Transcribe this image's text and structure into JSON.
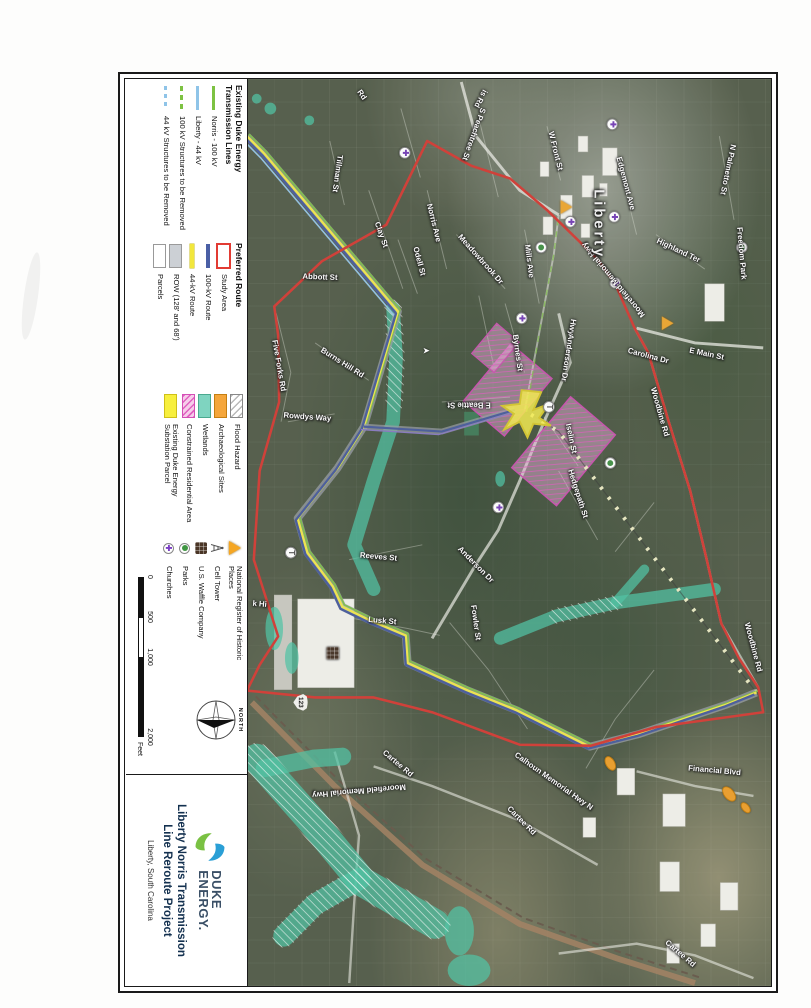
{
  "title_block": {
    "brand_line1": "DUKE",
    "brand_line2": "ENERGY.",
    "project_title_line1": "Liberty Norris Transmission",
    "project_title_line2": "Line Reroute Project",
    "location": "Liberty, South Carolina"
  },
  "legend": {
    "sections": [
      {
        "header": "Existing Duke Energy\nTransmission Lines",
        "items": [
          {
            "swatch": "line-green",
            "label": "Norris - 100 kV"
          },
          {
            "swatch": "line-lightblue",
            "label": "Liberty - 44 kV"
          },
          {
            "swatch": "dash-green",
            "label": "100 kV Structures to be Removed"
          },
          {
            "swatch": "dash-blue",
            "label": "44 kV Structures to be Removed"
          }
        ]
      },
      {
        "header": "Preferred Route",
        "items": [
          {
            "swatch": "rect-red-outline",
            "label": "Study Area"
          },
          {
            "swatch": "line-navy",
            "label": "100-kV Route"
          },
          {
            "swatch": "line-yellow",
            "label": "44-kV Route"
          },
          {
            "swatch": "rect-gray",
            "label": "ROW (128' and 68')"
          },
          {
            "swatch": "rect-white",
            "label": "Parcels"
          }
        ]
      },
      {
        "header": "",
        "items": [
          {
            "swatch": "rect-hatch-white",
            "label": "Flood Hazard"
          },
          {
            "swatch": "rect-orange",
            "label": "Archaeological Sites"
          },
          {
            "swatch": "rect-teal",
            "label": "Wetlands"
          },
          {
            "swatch": "rect-hatch-pink",
            "label": "Constrained Residential Area"
          },
          {
            "swatch": "rect-yellow",
            "label": "Existing Duke Energy Substation Parcel"
          }
        ]
      },
      {
        "header": "",
        "items": [
          {
            "swatch": "icon-triangle",
            "label": "National Register of Historic Places"
          },
          {
            "swatch": "icon-tower",
            "label": "Cell Tower"
          },
          {
            "swatch": "icon-waffle",
            "label": "U.S. Waffle Company"
          },
          {
            "swatch": "icon-park",
            "label": "Parks"
          },
          {
            "swatch": "icon-church",
            "label": "Churches"
          }
        ]
      }
    ],
    "scale": {
      "ticks": [
        "0",
        "500",
        "1,000",
        "2,000"
      ],
      "unit": "Feet"
    },
    "north_label": "NORTH"
  },
  "map": {
    "city_label": "Liberty",
    "highway_shield": "123",
    "streets": [
      {
        "name": "Rd",
        "x": 16,
        "y": 420,
        "a": -35
      },
      {
        "name": "is Rd",
        "x": 20,
        "y": 298,
        "a": 28
      },
      {
        "name": "Tillman St",
        "x": 96,
        "y": 445,
        "a": 8
      },
      {
        "name": "Clay St",
        "x": 158,
        "y": 400,
        "a": -20
      },
      {
        "name": "S Peachtree St",
        "x": 56,
        "y": 305,
        "a": 20
      },
      {
        "name": "Norris Ave",
        "x": 146,
        "y": 346,
        "a": -14
      },
      {
        "name": "Odell St",
        "x": 185,
        "y": 361,
        "a": -15
      },
      {
        "name": "Meadowbrook Dr",
        "x": 183,
        "y": 298,
        "a": -42
      },
      {
        "name": "Mills Ave",
        "x": 185,
        "y": 248,
        "a": -7
      },
      {
        "name": "Byrnes St",
        "x": 278,
        "y": 260,
        "a": -8
      },
      {
        "name": "Abbott St",
        "x": 201,
        "y": 463,
        "a": -88
      },
      {
        "name": "Burns Hill Rd",
        "x": 288,
        "y": 440,
        "a": -58
      },
      {
        "name": "Five Forks Rd",
        "x": 291,
        "y": 505,
        "a": -10
      },
      {
        "name": "Rowdys Way",
        "x": 343,
        "y": 476,
        "a": -86
      },
      {
        "name": "E Beattie St",
        "x": 331,
        "y": 310,
        "a": 90
      },
      {
        "name": "Iselin St",
        "x": 365,
        "y": 205,
        "a": -12
      },
      {
        "name": "Hedgepath St",
        "x": 421,
        "y": 198,
        "a": -18
      },
      {
        "name": "Hwy",
        "x": 252,
        "y": 204,
        "a": 9
      },
      {
        "name": "Anderson Dr",
        "x": 283,
        "y": 209,
        "a": 9
      },
      {
        "name": "Anderson Dr",
        "x": 493,
        "y": 303,
        "a": -45
      },
      {
        "name": "Carolina Dr",
        "x": 281,
        "y": 126,
        "a": -75
      },
      {
        "name": "E Main St",
        "x": 279,
        "y": 66,
        "a": -78
      },
      {
        "name": "Woodbine Rd",
        "x": 338,
        "y": 114,
        "a": -16
      },
      {
        "name": "Woodbine Rd",
        "x": 577,
        "y": 18,
        "a": -15
      },
      {
        "name": "Edgemont Ave",
        "x": 106,
        "y": 149,
        "a": -15
      },
      {
        "name": "W Front St",
        "x": 73,
        "y": 221,
        "a": -14
      },
      {
        "name": "Highland Ter",
        "x": 174,
        "y": 95,
        "a": -65
      },
      {
        "name": "N Palmetto St",
        "x": 92,
        "y": 44,
        "a": 12
      },
      {
        "name": "Freedom Park",
        "x": 177,
        "y": 30,
        "a": -5
      },
      {
        "name": "Moorefield Memorial Hwy",
        "x": 204,
        "y": 162,
        "a": 140
      },
      {
        "name": "Moorefield Memorial Hwy",
        "x": 723,
        "y": 423,
        "a": 85
      },
      {
        "name": "Reeves St",
        "x": 485,
        "y": 403,
        "a": -85
      },
      {
        "name": "Lusk St",
        "x": 550,
        "y": 399,
        "a": -85
      },
      {
        "name": "Fowler St",
        "x": 552,
        "y": 303,
        "a": -8
      },
      {
        "name": "k Hi",
        "x": 533,
        "y": 525,
        "a": -85
      },
      {
        "name": "Calhoun Memorial Hwy N",
        "x": 713,
        "y": 223,
        "a": -55
      },
      {
        "name": "Cartee Rd",
        "x": 753,
        "y": 256,
        "a": -45
      },
      {
        "name": "Cartee Rd",
        "x": 695,
        "y": 383,
        "a": -50
      },
      {
        "name": "Cartee Rd",
        "x": 888,
        "y": 93,
        "a": -50
      },
      {
        "name": "Financial Blvd",
        "x": 702,
        "y": 58,
        "a": -85
      }
    ],
    "pois": {
      "churches": [
        [
          75,
          376
        ],
        [
          46,
          163
        ],
        [
          145,
          206
        ],
        [
          140,
          161
        ],
        [
          207,
          160
        ],
        [
          243,
          256
        ],
        [
          435,
          280
        ]
      ],
      "parks": [
        [
          171,
          236
        ],
        [
          171,
          30
        ],
        [
          390,
          165
        ]
      ],
      "historic_markers": [
        [
          130,
          210
        ],
        [
          248,
          106
        ]
      ],
      "cell_towers": [
        [
          333,
          228
        ],
        [
          481,
          493
        ]
      ],
      "waffle": [
        [
          583,
          450
        ]
      ],
      "highway_shields": [
        [
          633,
          483
        ]
      ],
      "arch_sites": [
        [
          695,
          165,
          16,
          10,
          -30
        ],
        [
          726,
          43,
          18,
          11,
          -40
        ],
        [
          740,
          26,
          13,
          8,
          -40
        ]
      ],
      "flow_arrows": [
        [
          276,
          354
        ]
      ]
    }
  },
  "colors": {
    "study_area": "#e23b33",
    "route_100kv": "#4a5fa5",
    "route_44kv": "#f2e73c",
    "norris_100kv": "#7dc242",
    "liberty_44kv": "#8fc4e8",
    "wetlands": "#44c9a5",
    "constrained_residential": "#e060c0",
    "substation": "#f7ef3d",
    "archaeological": "#f59f1e"
  }
}
